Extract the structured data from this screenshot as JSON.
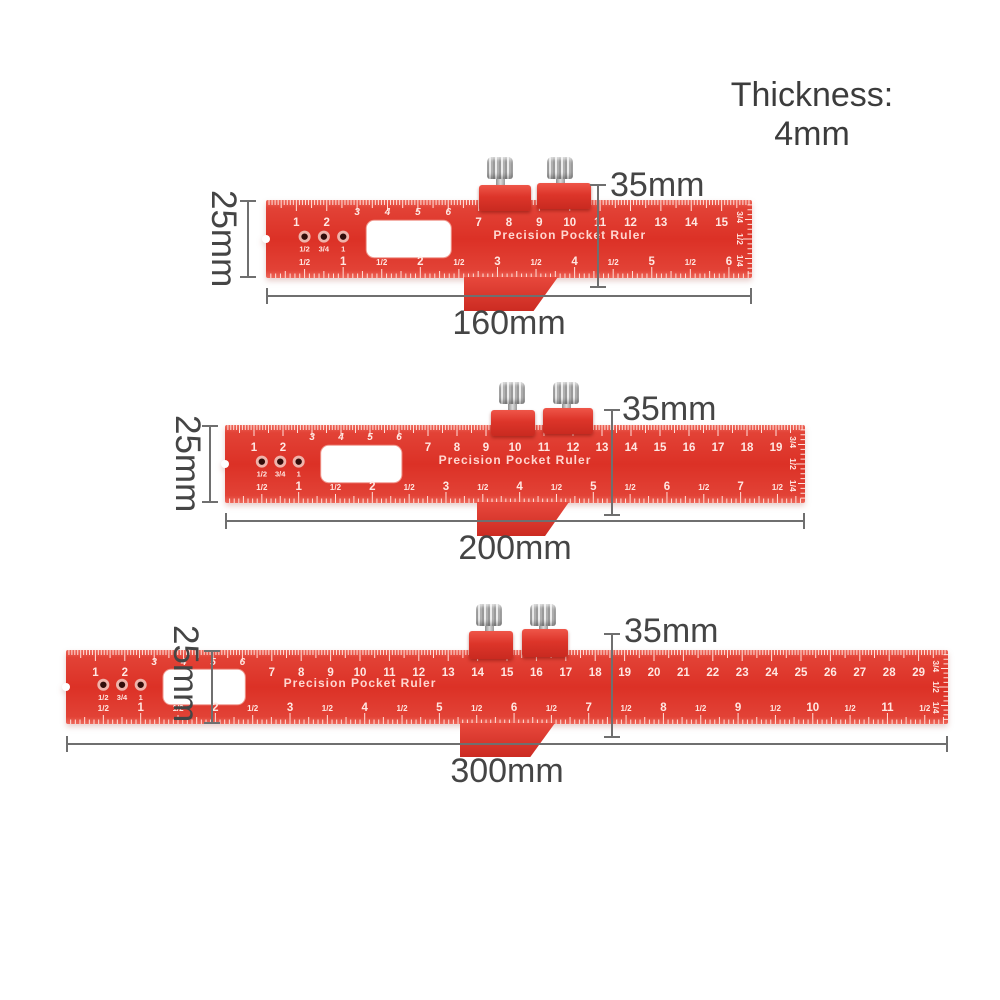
{
  "title": {
    "thickness_label": "Thickness: 4mm"
  },
  "colors": {
    "ruler_red": "#dc3126",
    "ruler_red_light": "#ee685b",
    "ruler_red_dark": "#c9271e",
    "tick_white": "#ffe0da",
    "number_white": "#ffe7e2",
    "engraving_white": "#ffd6cf",
    "slot_white": "#ffffff",
    "hole_ring": "#efb3aa",
    "hole_dark": "#310d0a",
    "screw_silver": "#cccccc",
    "dim_line_gray": "#6f6f6f",
    "dim_text_gray": "#454545"
  },
  "rulers": [
    {
      "name": "ruler-160mm",
      "length_mm": 160,
      "length_label": "160mm",
      "height_label": "25mm",
      "stop_height_label": "35mm",
      "engraving": "Precision Pocket Ruler",
      "cm_numbers": [
        1,
        2,
        3,
        4,
        5,
        6,
        7,
        8,
        9,
        10,
        11,
        12,
        13,
        14,
        15
      ],
      "raised_cm_numbers": [
        3,
        4,
        5,
        6
      ],
      "inch_numbers": [
        1,
        2,
        3,
        4,
        5,
        6
      ],
      "half_inch_label": "1/2",
      "trailing_half_inch": false,
      "hole_labels": [
        "1/2",
        "3/4",
        "1"
      ],
      "edge_fraction_labels": [
        "3/4",
        "1/2",
        "1/4"
      ]
    },
    {
      "name": "ruler-200mm",
      "length_mm": 200,
      "length_label": "200mm",
      "height_label": "25mm",
      "stop_height_label": "35mm",
      "engraving": "Precision Pocket Ruler",
      "cm_numbers": [
        1,
        2,
        3,
        4,
        5,
        6,
        7,
        8,
        9,
        10,
        11,
        12,
        13,
        14,
        15,
        16,
        17,
        18,
        19
      ],
      "raised_cm_numbers": [
        3,
        4,
        5,
        6
      ],
      "inch_numbers": [
        1,
        2,
        3,
        4,
        5,
        6,
        7
      ],
      "half_inch_label": "1/2",
      "trailing_half_inch": true,
      "hole_labels": [
        "1/2",
        "3/4",
        "1"
      ],
      "edge_fraction_labels": [
        "3/4",
        "1/2",
        "1/4"
      ]
    },
    {
      "name": "ruler-300mm",
      "length_mm": 300,
      "length_label": "300mm",
      "height_label": "25mm",
      "stop_height_label": "35mm",
      "engraving": "Precision Pocket Ruler",
      "cm_numbers": [
        1,
        2,
        3,
        4,
        5,
        6,
        7,
        8,
        9,
        10,
        11,
        12,
        13,
        14,
        15,
        16,
        17,
        18,
        19,
        20,
        21,
        22,
        23,
        24,
        25,
        26,
        27,
        28,
        29
      ],
      "raised_cm_numbers": [
        3,
        4,
        5,
        6
      ],
      "inch_numbers": [
        1,
        2,
        3,
        4,
        5,
        6,
        7,
        8,
        9,
        10,
        11
      ],
      "half_inch_label": "1/2",
      "trailing_half_inch": true,
      "hole_labels": [
        "1/2",
        "3/4",
        "1"
      ],
      "edge_fraction_labels": [
        "3/4",
        "1/2",
        "1/4"
      ]
    }
  ]
}
